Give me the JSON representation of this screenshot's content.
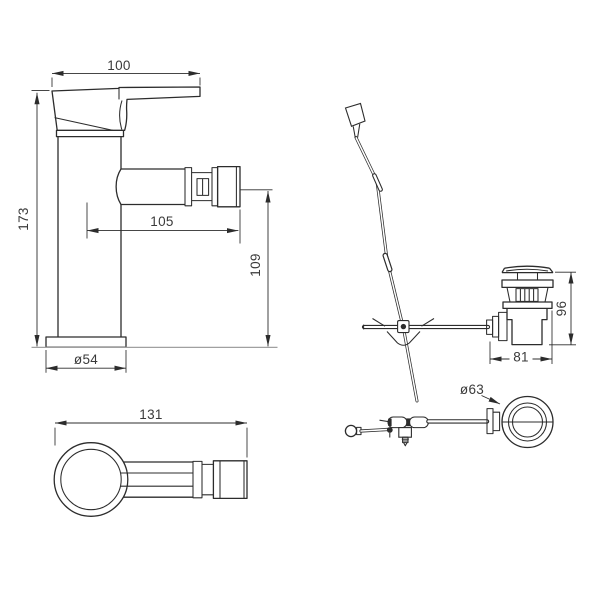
{
  "drawing": {
    "colors": {
      "line": "#2c2c2c",
      "surface_line": "#a0a0a0",
      "background": "#ffffff",
      "text": "#3a3a3a"
    },
    "dimensions": {
      "faucet_side": {
        "handle_length": "100",
        "overall_height": "173",
        "spout_reach": "105",
        "spout_outlet_height": "109",
        "base_diameter": "ø54"
      },
      "faucet_top": {
        "overall_depth": "131"
      },
      "waste_side": {
        "body_height": "96",
        "body_width": "81"
      },
      "waste_top": {
        "flange_diameter": "ø63"
      }
    }
  }
}
